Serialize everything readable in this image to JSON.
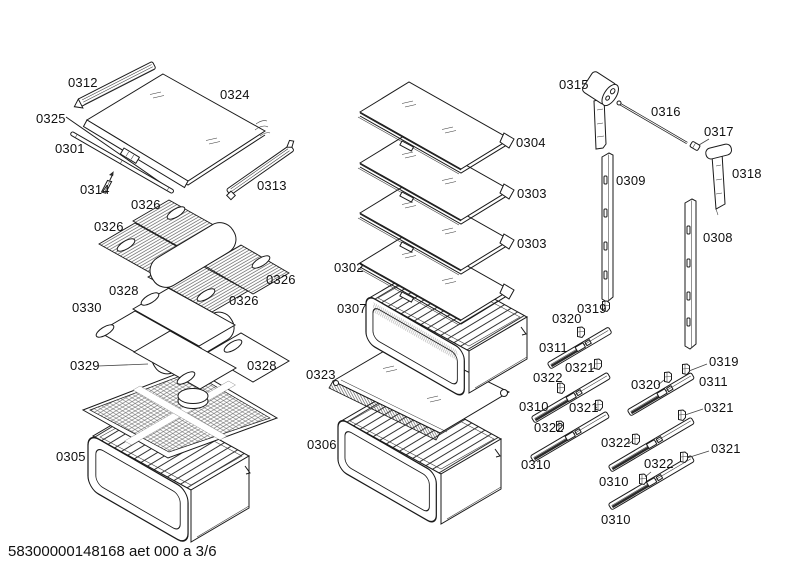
{
  "colors": {
    "background": "#ffffff",
    "line": "#1a1a1a"
  },
  "footer": {
    "code": "58300000148168 aet 000 a 3/6"
  },
  "labels": [
    {
      "part": "0312"
    },
    {
      "part": "0324"
    },
    {
      "part": "0325"
    },
    {
      "part": "0301"
    },
    {
      "part": "0314"
    },
    {
      "part": "0313"
    },
    {
      "part": "0326"
    },
    {
      "part": "0326"
    },
    {
      "part": "0326"
    },
    {
      "part": "0326"
    },
    {
      "part": "0328"
    },
    {
      "part": "0330"
    },
    {
      "part": "0329"
    },
    {
      "part": "0328"
    },
    {
      "part": "0305"
    },
    {
      "part": "0302"
    },
    {
      "part": "0307"
    },
    {
      "part": "0323"
    },
    {
      "part": "0306"
    },
    {
      "part": "0304"
    },
    {
      "part": "0303"
    },
    {
      "part": "0303"
    },
    {
      "part": "0315"
    },
    {
      "part": "0316"
    },
    {
      "part": "0317"
    },
    {
      "part": "0318"
    },
    {
      "part": "0309"
    },
    {
      "part": "0308"
    },
    {
      "part": "0319"
    },
    {
      "part": "0320"
    },
    {
      "part": "0311"
    },
    {
      "part": "0321"
    },
    {
      "part": "0322"
    },
    {
      "part": "0310"
    },
    {
      "part": "0321"
    },
    {
      "part": "0322"
    },
    {
      "part": "0310"
    },
    {
      "part": "0319"
    },
    {
      "part": "0320"
    },
    {
      "part": "0311"
    },
    {
      "part": "0321"
    },
    {
      "part": "0322"
    },
    {
      "part": "0310"
    },
    {
      "part": "0321"
    },
    {
      "part": "0322"
    },
    {
      "part": "0310"
    }
  ]
}
